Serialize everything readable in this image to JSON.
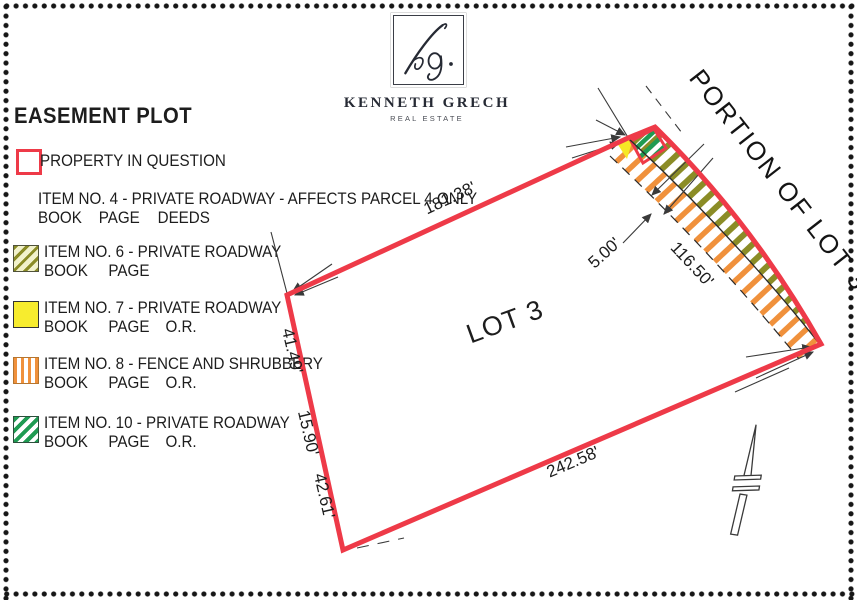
{
  "logo": {
    "monogram": "Kg.",
    "name": "KENNETH GRECH",
    "tagline": "REAL ESTATE"
  },
  "legend": {
    "title": "EASEMENT PLOT",
    "property": {
      "label": "PROPERTY IN QUESTION"
    },
    "item4": {
      "line1": "ITEM NO. 4 - PRIVATE ROADWAY - AFFECTS PARCEL 4 ONLY",
      "refs": [
        "BOOK",
        "PAGE",
        "DEEDS"
      ]
    },
    "item6": {
      "line1": "ITEM NO. 6 - PRIVATE ROADWAY",
      "refs": [
        "BOOK",
        "PAGE"
      ]
    },
    "item7": {
      "line1": "ITEM NO. 7 - PRIVATE ROADWAY",
      "refs": [
        "BOOK",
        "PAGE",
        "O.R."
      ]
    },
    "item8": {
      "line1": "ITEM NO. 8 - FENCE AND SHRUBBERY",
      "refs": [
        "BOOK",
        "PAGE",
        "O.R."
      ]
    },
    "item10": {
      "line1": "ITEM NO. 10 - PRIVATE ROADWAY",
      "refs": [
        "BOOK",
        "PAGE",
        "O.R."
      ]
    }
  },
  "plot": {
    "lot_label": "LOT 3",
    "adjacent_label": "PORTION OF LOT 36",
    "dimensions": {
      "top": "181.38'",
      "strip": "116.50'",
      "strip_width": "5.00'",
      "bottom": "242.58'",
      "left_upper": "41.49'",
      "left_middle": "15.90'",
      "left_lower": "42.61'"
    }
  },
  "colors": {
    "boundary_red": "#ee3a48",
    "roadway_olive": "#8b8c26",
    "fence_orange": "#f0913c",
    "roadway_green": "#1f9b52",
    "roadway_yellow": "#f6e926"
  }
}
